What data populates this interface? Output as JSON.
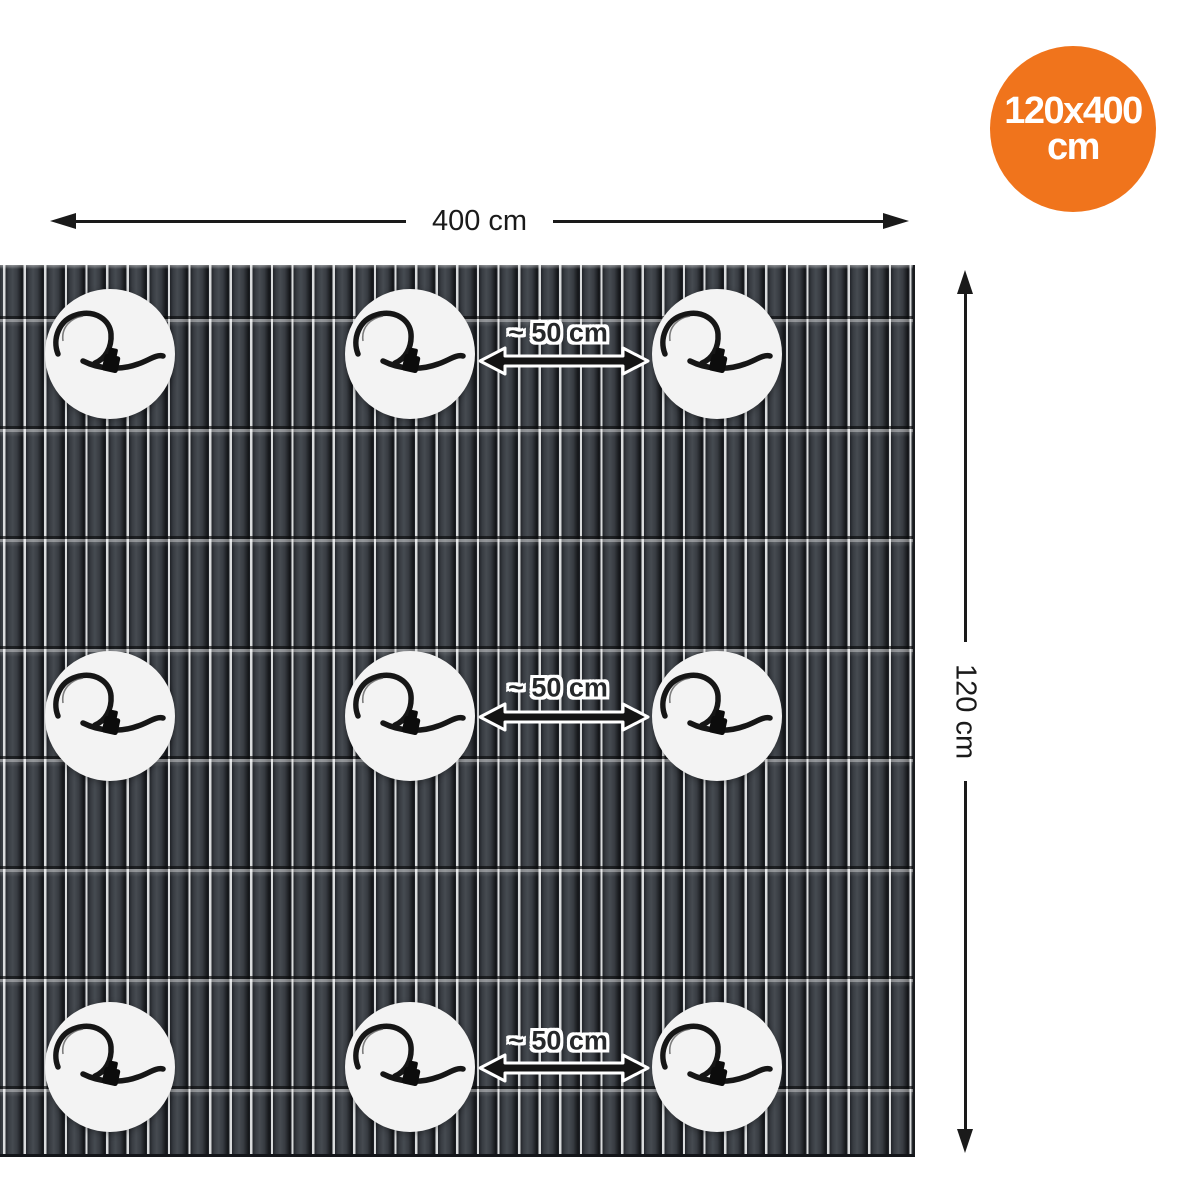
{
  "badge": {
    "size_text": "120x400",
    "unit_text": "cm",
    "background_color": "#F0741C",
    "text_color": "#FFFFFF"
  },
  "dimensions": {
    "width": {
      "label": "400 cm"
    },
    "height": {
      "label": "120 cm"
    }
  },
  "spacings": [
    {
      "label": "~ 50 cm"
    },
    {
      "label": "~ 50 cm"
    },
    {
      "label": "~ 50 cm"
    }
  ],
  "mat": {
    "grid_rows": 3,
    "grid_cols": 3,
    "slat_color": "#33373C",
    "slat_gap_color": "#D9DBDC",
    "marker_color": "#F3F3F3",
    "fastener": "cable-tie"
  },
  "colors": {
    "arrow_color": "#1A1A1A",
    "background": "#FFFFFF"
  },
  "icons": {
    "fastener": "cable-tie-icon",
    "spacing": "double-arrow-icon"
  }
}
